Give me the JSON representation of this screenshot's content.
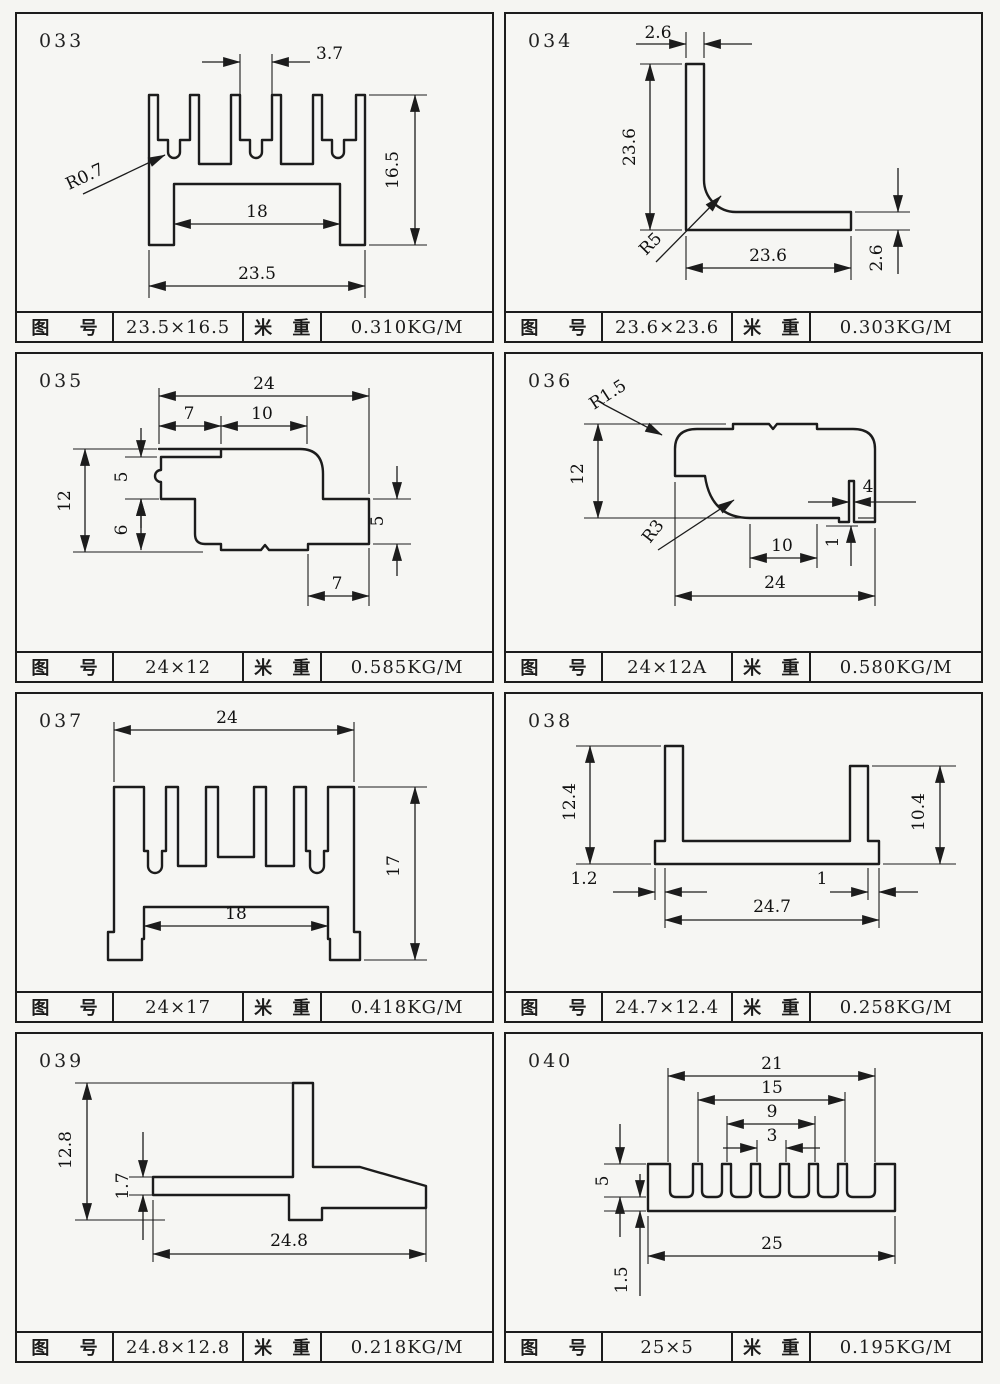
{
  "page": {
    "background": "#f5f5f2",
    "ink": "#1c1c1c",
    "description": "aluminium extrusion profile catalog sheet"
  },
  "labels": {
    "col1": "图 号",
    "col3": "米 重"
  },
  "cells": [
    {
      "code": "033",
      "size": "23.5×16.5",
      "weight": "0.310KG/M",
      "dims": {
        "top": "3.7",
        "height": "16.5",
        "inner": "18",
        "width": "23.5",
        "radius": "R0.7"
      }
    },
    {
      "code": "034",
      "size": "23.6×23.6",
      "weight": "0.303KG/M",
      "dims": {
        "thickness_top": "2.6",
        "height": "23.6",
        "width": "23.6",
        "thickness_right": "2.6",
        "radius": "R5"
      }
    },
    {
      "code": "035",
      "size": "24×12",
      "weight": "0.585KG/M",
      "dims": {
        "width": "24",
        "seg7": "7",
        "seg10": "10",
        "height": "12",
        "left5": "5",
        "left6": "6",
        "right5": "5",
        "bottom7": "7"
      }
    },
    {
      "code": "036",
      "size": "24×12A",
      "weight": "0.580KG/M",
      "dims": {
        "radius_top": "R1.5",
        "height": "12",
        "radius_inner": "R3",
        "inner": "10",
        "right4": "4",
        "step1": "1",
        "width": "24"
      }
    },
    {
      "code": "037",
      "size": "24×17",
      "weight": "0.418KG/M",
      "dims": {
        "width": "24",
        "height": "17",
        "inner": "18"
      }
    },
    {
      "code": "038",
      "size": "24.7×12.4",
      "weight": "0.258KG/M",
      "dims": {
        "left_height": "12.4",
        "right_height": "10.4",
        "left_offset": "1.2",
        "width": "24.7",
        "right_offset": "1"
      }
    },
    {
      "code": "039",
      "size": "24.8×12.8",
      "weight": "0.218KG/M",
      "dims": {
        "height": "12.8",
        "thickness": "1.7",
        "width": "24.8"
      }
    },
    {
      "code": "040",
      "size": "25×5",
      "weight": "0.195KG/M",
      "dims": {
        "w21": "21",
        "w15": "15",
        "w9": "9",
        "w3": "3",
        "height": "5",
        "base": "1.5",
        "width": "25"
      }
    }
  ]
}
